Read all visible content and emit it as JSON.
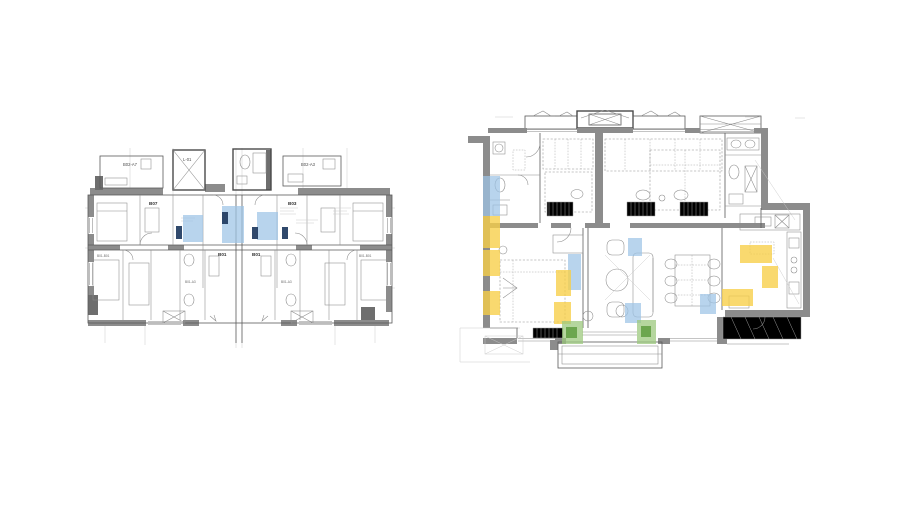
{
  "document": {
    "kind": "architectural floor plan comparison",
    "background": "#ffffff"
  },
  "highlight_colors": {
    "blue": "#9DC3E6",
    "yellow": "#F7CE46",
    "green": "#9CC87E",
    "green_dark": "#5F9E3F",
    "navy": "#1E3A5F"
  },
  "left_plan": {
    "name": "multi-unit-key-plan",
    "labels": {
      "top_left_room": "B02-A7",
      "shaft": "L-01",
      "top_right_room": "B02-A3",
      "unit_left": "B07",
      "unit_right": "B03",
      "core_left": "B01",
      "core_right": "B01",
      "edge_left": "B01-B01",
      "edge_right": "B01-B01",
      "bath_left": "B01-A3",
      "bath_right": "B01-A3"
    }
  },
  "right_plan": {
    "name": "apartment-detail-plan"
  }
}
